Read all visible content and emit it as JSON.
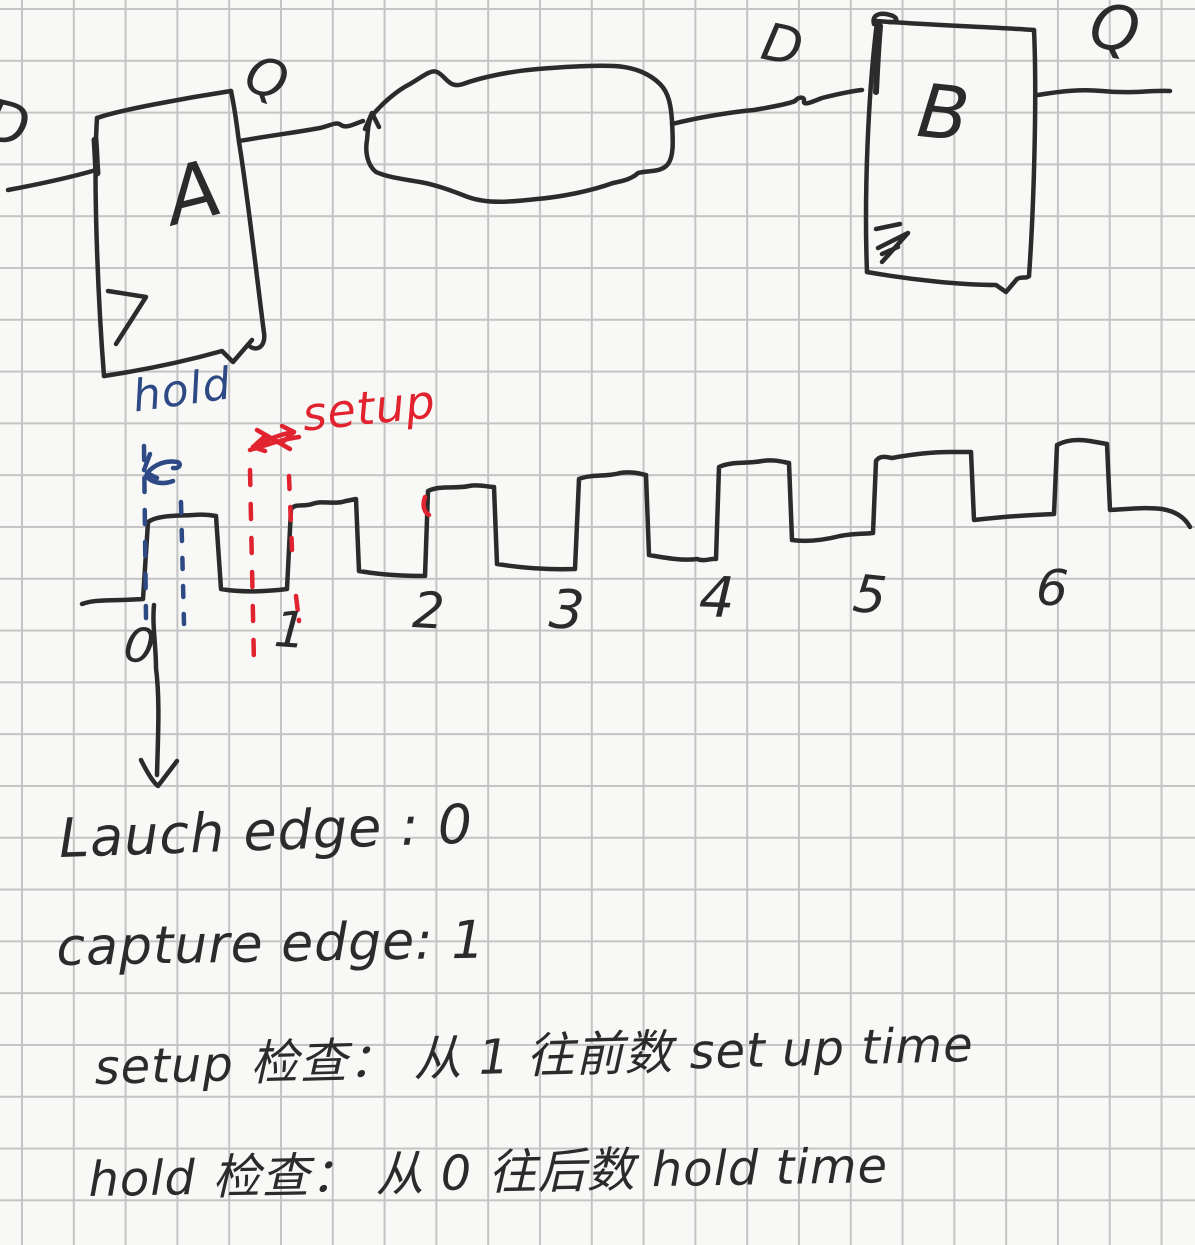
{
  "page": {
    "type": "handwritten-notes-grid-paper",
    "background": "#f8f8f6",
    "grid_color": "#c4c4c4",
    "ink_color": "#2b2b2b",
    "hold_color": "#2e4a85",
    "setup_color": "#e0232f"
  },
  "circuit": {
    "ff_a": {
      "name_label": "A",
      "input_label": "D",
      "output_label": "Q",
      "clock_icon": "clock-edge-triangle-icon"
    },
    "cloud_icon": "combinational-logic-cloud-icon",
    "ff_b": {
      "name_label": "B",
      "input_label": "D",
      "output_label": "Q",
      "clock_icon": "clock-edge-triangle-icon"
    }
  },
  "timing": {
    "hold_label": "hold",
    "setup_label": "setup",
    "edge_numbers": [
      "0",
      "1",
      "2",
      "3",
      "4",
      "5",
      "6"
    ],
    "launch_edge_marker": "0",
    "capture_edge_marker": "1"
  },
  "notes": {
    "launch_line": "Lauch edge : 0",
    "capture_line": "capture edge: 1",
    "setup_check_line": "setup 检查： 从 1 往前数 set up time",
    "hold_check_line": "hold 检查： 从 0 往后数 hold time"
  }
}
